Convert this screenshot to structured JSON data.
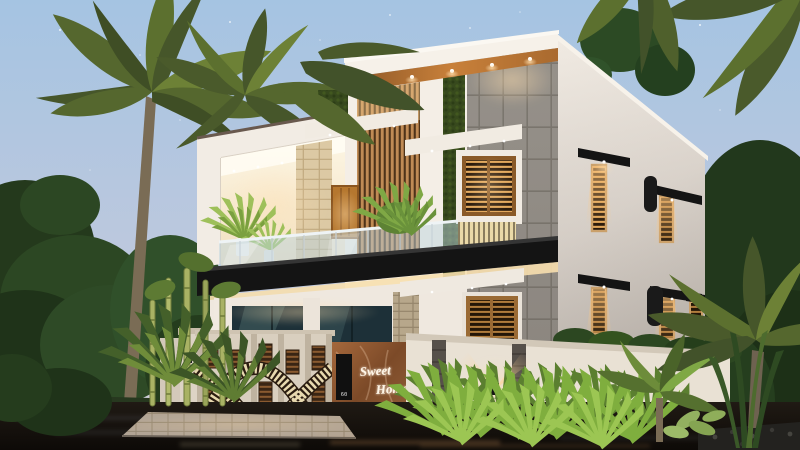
{
  "scene": {
    "type": "3D architectural exterior rendering",
    "time_of_day": "dusk",
    "subject": "Modern two-storey residence with wooden louvers, vertical gardens, glass balcony and palm trees"
  },
  "nameplate": {
    "line1": "Sweet",
    "line2": "Home",
    "house_number": "60"
  },
  "palette": {
    "sky_top": "#a5c4e2",
    "sky_horizon": "#d7d2da",
    "wall_white": "#f4eee6",
    "wall_side": "#ded7cf",
    "wood_slat": "#c08b55",
    "wood_soffit": "#b5712f",
    "green_wall": "#37491d",
    "stone_tile": "#96918a",
    "black_trim": "#161616",
    "warm_light": "#ffd9a0",
    "glass_railing": "#bcd4de",
    "compound_wall": "#e6ddcf",
    "marble_sign": "#8a5430",
    "gate_slat": "#e7d8ae",
    "foliage_dark": "#2c4423",
    "grass_bright": "#7fae3e",
    "wet_road": "#17120e"
  }
}
